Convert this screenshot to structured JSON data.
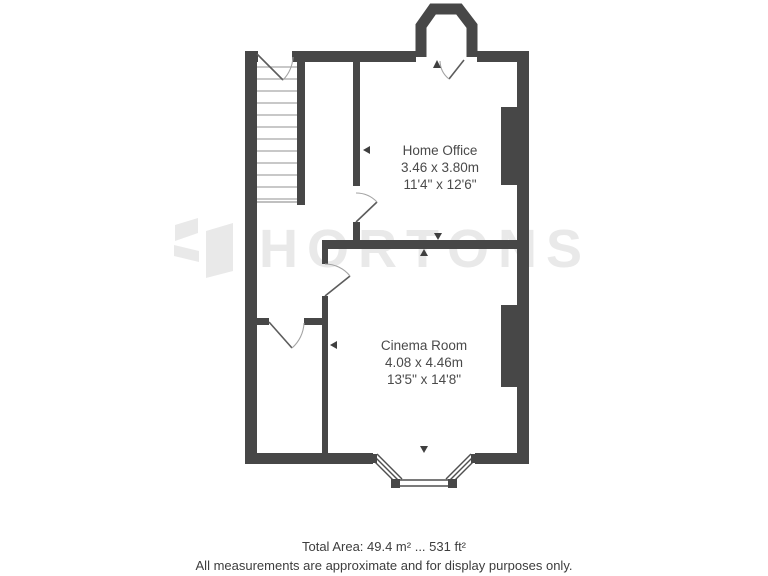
{
  "watermark": {
    "brand": "HORTONS"
  },
  "rooms": [
    {
      "name": "Home Office",
      "size_metric": "3.46 x 3.80m",
      "size_imperial": "11'4\" x 12'6\""
    },
    {
      "name": "Cinema Room",
      "size_metric": "4.08 x 4.46m",
      "size_imperial": "13'5\" x 14'8\""
    }
  ],
  "footer": {
    "total_area": "Total Area: 49.4 m² ... 531 ft²",
    "disclaimer": "All measurements are approximate and for display purposes only."
  },
  "colors": {
    "wall": "#474747",
    "watermark": "#e9e9e9",
    "label_text": "#4a4a4a",
    "footer_text": "#3d3d3d"
  }
}
